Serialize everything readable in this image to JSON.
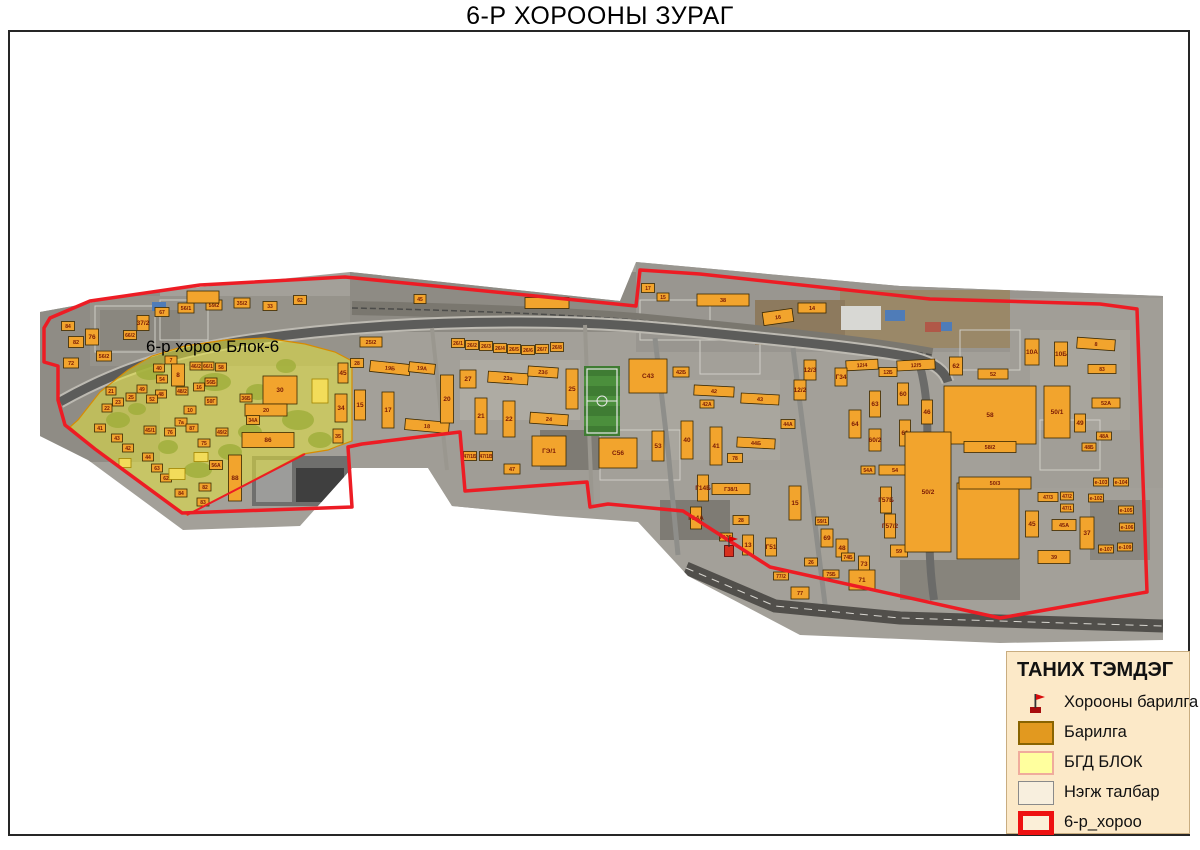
{
  "title": "6-Р ХОРООНЫ ЗУРАГ",
  "map": {
    "block_label": "6-р хороо Блок-6",
    "colors": {
      "boundary_red": "#ED1C24",
      "building_orange": "#F2A42D",
      "block_yellow": "#E6E33C",
      "legend_background": "#FCE9C8"
    },
    "buildings": [
      [
        68,
        326,
        13,
        9,
        "84"
      ],
      [
        76,
        342,
        15,
        11,
        "82"
      ],
      [
        71,
        363,
        15,
        10,
        "72"
      ],
      [
        92,
        337,
        13,
        16,
        "76"
      ],
      [
        104,
        356,
        15,
        10,
        "56/2"
      ],
      [
        130,
        335,
        13,
        9,
        "66/2"
      ],
      [
        143,
        323,
        12,
        15,
        "37/2"
      ],
      [
        162,
        312,
        14,
        9,
        "67"
      ],
      [
        186,
        308,
        16,
        10,
        "56/1"
      ],
      [
        214,
        305,
        16,
        10,
        "59/2"
      ],
      [
        203,
        297,
        32,
        12,
        ""
      ],
      [
        242,
        303,
        16,
        10,
        "35/2"
      ],
      [
        270,
        306,
        14,
        9,
        "33"
      ],
      [
        300,
        300,
        13,
        9,
        "62"
      ],
      [
        420,
        299,
        12,
        9,
        "45"
      ],
      [
        547,
        303,
        44,
        11,
        ""
      ],
      [
        648,
        288,
        13,
        9,
        "17"
      ],
      [
        663,
        297,
        12,
        8,
        "15"
      ],
      [
        723,
        300,
        52,
        12,
        "38"
      ],
      [
        778,
        317,
        30,
        13,
        "16",
        -8
      ],
      [
        812,
        308,
        28,
        10,
        "14"
      ],
      [
        171,
        360,
        12,
        8,
        "7"
      ],
      [
        159,
        368,
        11,
        8,
        "40"
      ],
      [
        162,
        379,
        11,
        8,
        "54"
      ],
      [
        178,
        375,
        13,
        22,
        "8"
      ],
      [
        196,
        366,
        12,
        8,
        "46/2"
      ],
      [
        208,
        366,
        12,
        8,
        "66/1"
      ],
      [
        221,
        367,
        11,
        8,
        "58"
      ],
      [
        161,
        394,
        11,
        8,
        "48"
      ],
      [
        182,
        391,
        12,
        8,
        "48/2"
      ],
      [
        199,
        387,
        11,
        8,
        "16"
      ],
      [
        211,
        382,
        12,
        8,
        "56Б"
      ],
      [
        211,
        401,
        12,
        8,
        "50Г"
      ],
      [
        152,
        399,
        11,
        8,
        "52"
      ],
      [
        142,
        389,
        10,
        8,
        "49"
      ],
      [
        131,
        397,
        10,
        8,
        "25"
      ],
      [
        118,
        402,
        11,
        8,
        "23"
      ],
      [
        107,
        408,
        10,
        8,
        "22"
      ],
      [
        111,
        391,
        10,
        8,
        "21"
      ],
      [
        280,
        390,
        34,
        28,
        "30"
      ],
      [
        266,
        410,
        42,
        12,
        "20"
      ],
      [
        343,
        373,
        10,
        20,
        "45"
      ],
      [
        341,
        408,
        12,
        28,
        "34"
      ],
      [
        338,
        436,
        10,
        14,
        "35"
      ],
      [
        253,
        420,
        13,
        9,
        "34А"
      ],
      [
        216,
        465,
        13,
        9,
        "56А"
      ],
      [
        268,
        440,
        52,
        15,
        "86"
      ],
      [
        235,
        478,
        13,
        46,
        "88"
      ],
      [
        205,
        487,
        12,
        8,
        "82"
      ],
      [
        181,
        493,
        12,
        8,
        "84"
      ],
      [
        203,
        502,
        12,
        8,
        "83"
      ],
      [
        166,
        478,
        11,
        8,
        "62"
      ],
      [
        157,
        468,
        11,
        8,
        "63"
      ],
      [
        148,
        457,
        11,
        8,
        "44"
      ],
      [
        128,
        448,
        11,
        8,
        "42"
      ],
      [
        117,
        438,
        11,
        8,
        "43"
      ],
      [
        100,
        428,
        11,
        8,
        "41"
      ],
      [
        150,
        430,
        12,
        8,
        "45/1"
      ],
      [
        170,
        432,
        11,
        8,
        "76"
      ],
      [
        181,
        422,
        12,
        8,
        "7а"
      ],
      [
        192,
        428,
        12,
        8,
        "87"
      ],
      [
        204,
        443,
        12,
        8,
        "75"
      ],
      [
        222,
        432,
        12,
        8,
        "49/2"
      ],
      [
        246,
        398,
        12,
        8,
        "36Б"
      ],
      [
        190,
        410,
        12,
        8,
        "10"
      ],
      [
        177,
        474,
        16,
        11,
        "",
        0,
        "y"
      ],
      [
        201,
        457,
        14,
        9,
        "",
        0,
        "y"
      ],
      [
        320,
        391,
        16,
        24,
        "",
        0,
        "y"
      ],
      [
        125,
        463,
        12,
        9,
        "",
        0,
        "y"
      ],
      [
        371,
        342,
        22,
        10,
        "25/2"
      ],
      [
        357,
        363,
        13,
        9,
        "28"
      ],
      [
        390,
        368,
        40,
        11,
        "19Б",
        6
      ],
      [
        422,
        368,
        26,
        10,
        "19А",
        6
      ],
      [
        360,
        405,
        11,
        30,
        "15"
      ],
      [
        388,
        410,
        12,
        36,
        "17"
      ],
      [
        427,
        426,
        44,
        11,
        "18",
        5
      ],
      [
        447,
        399,
        13,
        48,
        "20"
      ],
      [
        468,
        379,
        16,
        18,
        "27"
      ],
      [
        458,
        343,
        13,
        9,
        "26/1"
      ],
      [
        472,
        345,
        13,
        9,
        "26/2"
      ],
      [
        486,
        346,
        13,
        9,
        "26/3"
      ],
      [
        500,
        348,
        13,
        9,
        "26/4"
      ],
      [
        514,
        349,
        13,
        9,
        "26/5"
      ],
      [
        528,
        350,
        13,
        9,
        "26/6"
      ],
      [
        542,
        349,
        13,
        9,
        "26/7"
      ],
      [
        557,
        347,
        13,
        9,
        "26/8"
      ],
      [
        508,
        378,
        40,
        11,
        "23а",
        4
      ],
      [
        543,
        372,
        30,
        10,
        "23б",
        4
      ],
      [
        481,
        416,
        12,
        36,
        "21"
      ],
      [
        509,
        419,
        12,
        36,
        "22"
      ],
      [
        549,
        419,
        38,
        11,
        "24",
        4
      ],
      [
        572,
        389,
        12,
        40,
        "25"
      ],
      [
        549,
        451,
        34,
        30,
        "ГЭ/1"
      ],
      [
        470,
        456,
        13,
        9,
        "47/1Б"
      ],
      [
        486,
        456,
        13,
        9,
        "47/1В"
      ],
      [
        512,
        469,
        16,
        10,
        "47"
      ],
      [
        648,
        376,
        38,
        34,
        "C43"
      ],
      [
        681,
        372,
        16,
        10,
        "42Б"
      ],
      [
        714,
        391,
        40,
        10,
        "42",
        3
      ],
      [
        707,
        404,
        14,
        8,
        "42А"
      ],
      [
        760,
        399,
        38,
        10,
        "43",
        3
      ],
      [
        687,
        440,
        12,
        38,
        "40"
      ],
      [
        716,
        446,
        12,
        38,
        "41"
      ],
      [
        618,
        453,
        38,
        30,
        "C56"
      ],
      [
        658,
        446,
        12,
        30,
        "53"
      ],
      [
        756,
        443,
        38,
        10,
        "44Б",
        3
      ],
      [
        788,
        424,
        14,
        9,
        "44А"
      ],
      [
        735,
        458,
        15,
        9,
        "78"
      ],
      [
        731,
        489,
        38,
        11,
        "Г38/1"
      ],
      [
        703,
        488,
        11,
        26,
        "Г14Б"
      ],
      [
        696,
        518,
        11,
        22,
        "Г14А"
      ],
      [
        741,
        520,
        16,
        9,
        "28"
      ],
      [
        726,
        537,
        13,
        8,
        "Г12Б"
      ],
      [
        748,
        545,
        11,
        20,
        "13"
      ],
      [
        771,
        547,
        11,
        18,
        "Г51"
      ],
      [
        795,
        503,
        12,
        34,
        "15"
      ],
      [
        822,
        521,
        13,
        8,
        "59/1"
      ],
      [
        827,
        538,
        12,
        18,
        "69"
      ],
      [
        842,
        548,
        12,
        18,
        "48"
      ],
      [
        831,
        574,
        16,
        8,
        "75Б"
      ],
      [
        811,
        562,
        13,
        8,
        "26"
      ],
      [
        848,
        557,
        13,
        8,
        "74Б"
      ],
      [
        864,
        564,
        11,
        16,
        "73"
      ],
      [
        862,
        580,
        26,
        20,
        "71"
      ],
      [
        800,
        593,
        18,
        12,
        "77"
      ],
      [
        781,
        576,
        15,
        8,
        "77/2"
      ],
      [
        915,
        495,
        12,
        34,
        "55"
      ],
      [
        895,
        470,
        32,
        10,
        "54"
      ],
      [
        868,
        470,
        14,
        8,
        "54А"
      ],
      [
        886,
        500,
        11,
        26,
        "Г57Б"
      ],
      [
        890,
        526,
        11,
        24,
        "Г57/2"
      ],
      [
        919,
        526,
        12,
        36,
        "56"
      ],
      [
        899,
        551,
        17,
        12,
        "59"
      ],
      [
        918,
        547,
        14,
        8,
        "59А"
      ],
      [
        916,
        365,
        38,
        10,
        "12/5",
        -3
      ],
      [
        888,
        372,
        18,
        9,
        "12Б"
      ],
      [
        903,
        394,
        11,
        22,
        "60"
      ],
      [
        875,
        404,
        11,
        26,
        "63"
      ],
      [
        905,
        433,
        11,
        26,
        "61"
      ],
      [
        927,
        412,
        11,
        24,
        "46"
      ],
      [
        862,
        365,
        32,
        10,
        "12/4",
        -3
      ],
      [
        841,
        377,
        12,
        18,
        "Г34"
      ],
      [
        810,
        370,
        12,
        20,
        "12/3"
      ],
      [
        800,
        390,
        12,
        20,
        "12/2"
      ],
      [
        855,
        424,
        12,
        28,
        "64"
      ],
      [
        875,
        440,
        12,
        22,
        "60/2"
      ],
      [
        956,
        366,
        13,
        18,
        "62"
      ],
      [
        993,
        374,
        30,
        10,
        "52"
      ],
      [
        1032,
        352,
        14,
        26,
        "10А"
      ],
      [
        1061,
        354,
        13,
        24,
        "10Б"
      ],
      [
        1096,
        344,
        38,
        11,
        "8",
        4
      ],
      [
        1102,
        369,
        28,
        9,
        "83"
      ],
      [
        1106,
        403,
        28,
        10,
        "52А"
      ],
      [
        1080,
        423,
        11,
        18,
        "49"
      ],
      [
        1104,
        436,
        15,
        8,
        "48А"
      ],
      [
        1089,
        447,
        14,
        8,
        "48Б"
      ],
      [
        990,
        415,
        92,
        58,
        "58"
      ],
      [
        1057,
        412,
        26,
        52,
        "50/1"
      ],
      [
        928,
        492,
        46,
        120,
        "50/2"
      ],
      [
        988,
        521,
        62,
        76,
        ""
      ],
      [
        990,
        447,
        52,
        11,
        "58/2"
      ],
      [
        995,
        483,
        72,
        12,
        "50/3"
      ],
      [
        1048,
        497,
        20,
        9,
        "47/3"
      ],
      [
        1067,
        496,
        13,
        8,
        "47/2"
      ],
      [
        1067,
        508,
        13,
        8,
        "47/1"
      ],
      [
        1032,
        524,
        13,
        26,
        "45"
      ],
      [
        1064,
        525,
        24,
        11,
        "45А"
      ],
      [
        1087,
        533,
        14,
        32,
        "37"
      ],
      [
        1054,
        557,
        32,
        13,
        "39"
      ],
      [
        1101,
        482,
        15,
        8,
        "e-103"
      ],
      [
        1121,
        482,
        15,
        8,
        "e-104"
      ],
      [
        1096,
        498,
        15,
        8,
        "e-102"
      ],
      [
        1126,
        510,
        15,
        8,
        "e-105"
      ],
      [
        1127,
        527,
        15,
        8,
        "e-106"
      ],
      [
        1106,
        549,
        15,
        8,
        "e-107"
      ],
      [
        1125,
        547,
        15,
        8,
        "e-109"
      ],
      [
        729,
        551,
        9,
        11,
        "",
        0,
        "r"
      ]
    ]
  },
  "legend": {
    "title": "ТАНИХ ТЭМДЭГ",
    "items": [
      {
        "label": "Хорооны барилга",
        "type": "flag"
      },
      {
        "label": "Барилга",
        "type": "building"
      },
      {
        "label": "БГД БЛОК",
        "type": "block"
      },
      {
        "label": "Нэгж талбар",
        "type": "parcel"
      },
      {
        "label": "6-р_хороо",
        "type": "khoroo"
      }
    ]
  }
}
